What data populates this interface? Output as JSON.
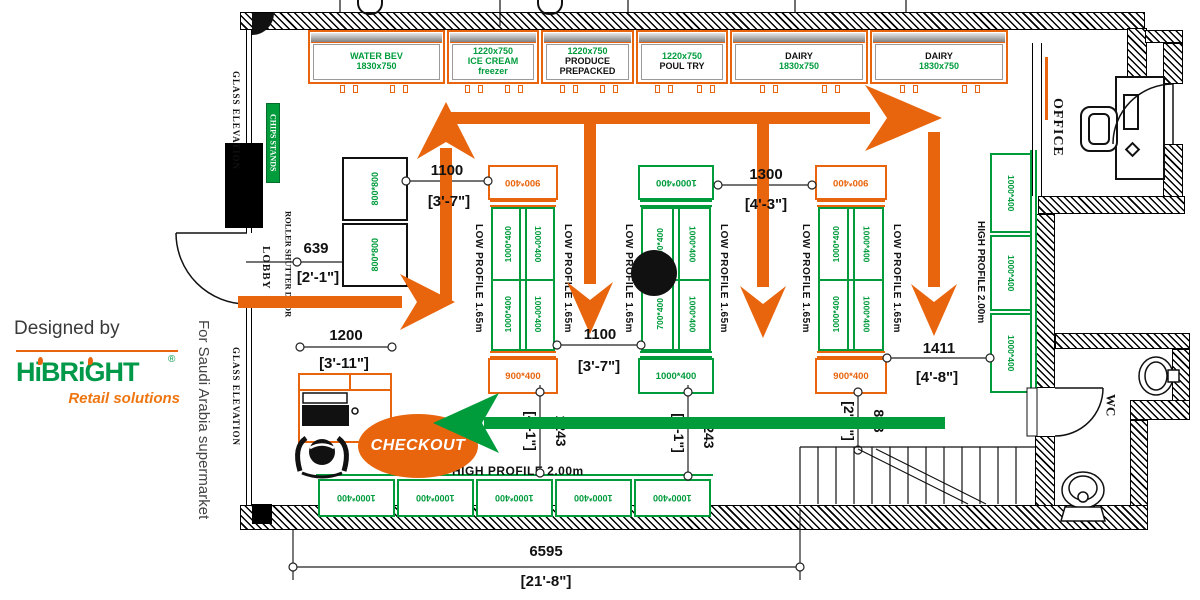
{
  "branding": {
    "designed_by": "Designed by",
    "logo": "HiBRiGHT",
    "registered": "®",
    "tagline": "Retail solutions",
    "project": "For Saudi Arabia supermarket"
  },
  "labels": {
    "office": "OFFICE",
    "wc": "WC",
    "lobby": "LOBBY",
    "glass_elevation_top": "GLASS ELEVATION",
    "glass_elevation_bottom": "GLASS ELEVATION",
    "chips_stands": "CHIPS STANDS",
    "roller_shutter_door": "ROLLER SHUTTER DOOR",
    "low_profile": "LOW PROFILE 1.65m",
    "high_profile": "HIGH PROFILE 2.00m",
    "checkout": "CHECKOUT",
    "table": "800*800"
  },
  "coolers": [
    [
      "WATER BEV",
      "1830x750"
    ],
    [
      "1220x750",
      "ICE CREAM",
      "freezer"
    ],
    [
      "1220x750",
      "PRODUCE",
      "PREPACKED"
    ],
    [
      "1220x750",
      "POUL TRY"
    ],
    [
      "DAIRY",
      "1830x750"
    ],
    [
      "DAIRY",
      "1830x750"
    ]
  ],
  "gondolas": [
    {
      "top": "900*400",
      "bottom": "900*400",
      "cells": [
        "1000*400",
        "1000*400",
        "1000*400",
        "1000*400"
      ]
    },
    {
      "top": "1000*400",
      "bottom": "1000*400",
      "cells": [
        "700*400",
        "1000*400",
        "700*400",
        "1000*400"
      ]
    },
    {
      "top": "900*400",
      "bottom": "900*400",
      "cells": [
        "1000*400",
        "1000*400",
        "1000*400",
        "1000*400"
      ]
    }
  ],
  "right_shelves": [
    "1000*400",
    "1000*400",
    "1000*400"
  ],
  "bottom_shelves": [
    "1000*400",
    "1000*400",
    "1000*400",
    "1000*400",
    "1000*400"
  ],
  "dims": {
    "d639": {
      "mm": "639",
      "ft": "[2'-1\"]"
    },
    "d1100a": {
      "mm": "1100",
      "ft": "[3'-7\"]"
    },
    "d1300": {
      "mm": "1300",
      "ft": "[4'-3\"]"
    },
    "d1200": {
      "mm": "1200",
      "ft": "[3'-11\"]"
    },
    "d1100b": {
      "mm": "1100",
      "ft": "[3'-7\"]"
    },
    "d1411": {
      "mm": "1411",
      "ft": "[4'-8\"]"
    },
    "d1243a": {
      "mm": "1243",
      "ft": "[4'-1\"]"
    },
    "d1243b": {
      "mm": "1243",
      "ft": "[4'-1\"]"
    },
    "d813": {
      "mm": "813",
      "ft": "[2'-8\"]"
    },
    "d6595": {
      "mm": "6595",
      "ft": "[21'-8\"]"
    }
  },
  "colors": {
    "accent_orange": "#e8650d",
    "shelf_green": "#009c3c",
    "logo_green": "#009949",
    "wall_black": "#111111"
  }
}
